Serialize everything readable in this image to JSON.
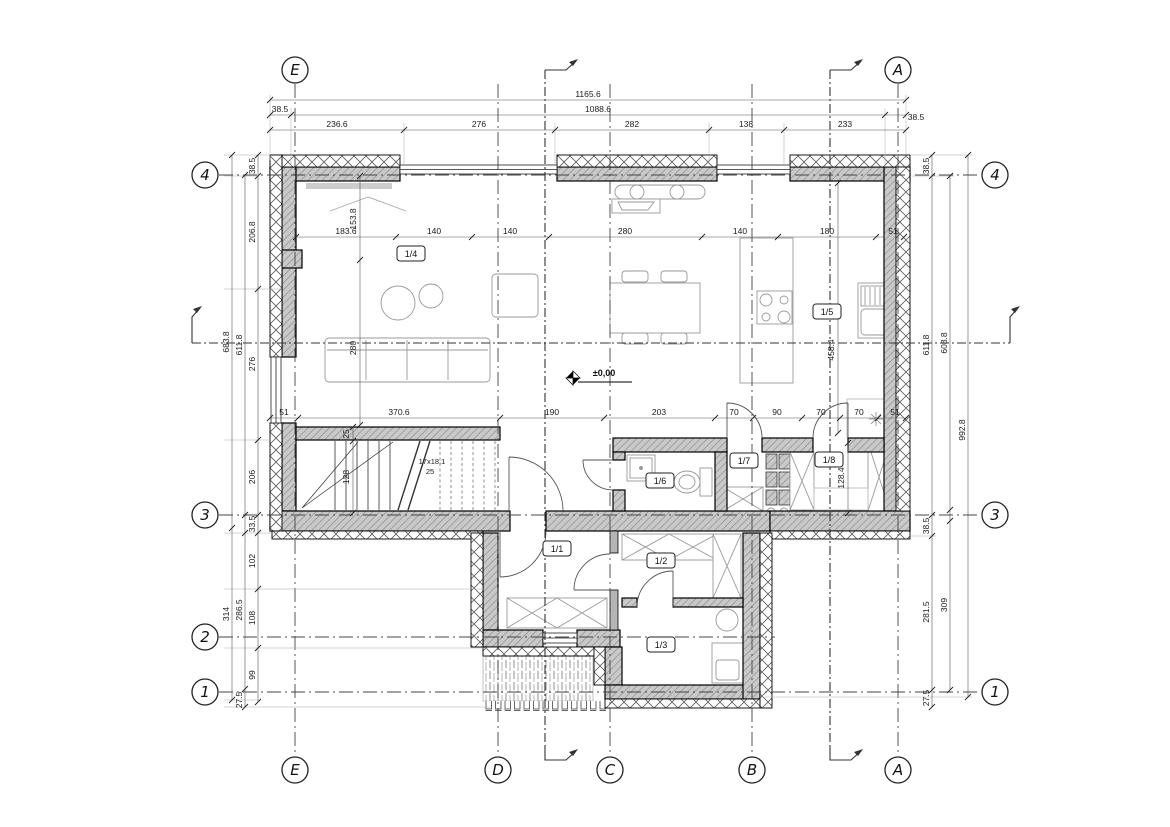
{
  "colors": {
    "line": "#1a1a1a",
    "wall_hatch": "#c9c9c9"
  },
  "grid": {
    "top": [
      "E",
      "A"
    ],
    "bottom": [
      "E",
      "D",
      "C",
      "B",
      "A"
    ],
    "left": [
      "4",
      "3",
      "2",
      "1"
    ],
    "right": [
      "4",
      "3",
      "1"
    ]
  },
  "rooms": {
    "r11": "1/1",
    "r12": "1/2",
    "r13": "1/3",
    "r14": "1/4",
    "r15": "1/5",
    "r16": "1/6",
    "r17": "1/7",
    "r18": "1/8"
  },
  "dims": {
    "total_width": "1165.6",
    "top_row2": [
      "38.5",
      "1088.6",
      "38.5"
    ],
    "top_row3": [
      "236.6",
      "276",
      "282",
      "138",
      "233"
    ],
    "upper_interior": [
      "183.6",
      "140",
      "140",
      "280",
      "140",
      "180",
      "51"
    ],
    "mid_interior": [
      "51",
      "370.6",
      "190",
      "203",
      "70",
      "90",
      "70",
      "70",
      "51"
    ],
    "window_v": [
      "153.8",
      "280"
    ],
    "left_col1": [
      "683.8",
      "314"
    ],
    "left_col2": [
      "611.8",
      "286.5",
      "27.5"
    ],
    "left_col3": [
      "38.5",
      "206.8",
      "276",
      "206",
      "33.5",
      "102",
      "108",
      "99"
    ],
    "right_col1": [
      "38.5",
      "611.8",
      "38.5",
      "281.5",
      "27.5"
    ],
    "right_col2": [
      "608.8",
      "309"
    ],
    "right_total": "992.8",
    "kitchen_v": "458.4",
    "closet_v": "128.4",
    "stair_v": [
      "25",
      "128"
    ]
  },
  "stairs": {
    "steps_note": "17x18.1",
    "width_note": "25"
  },
  "level_marker": {
    "text": "±0,00"
  }
}
